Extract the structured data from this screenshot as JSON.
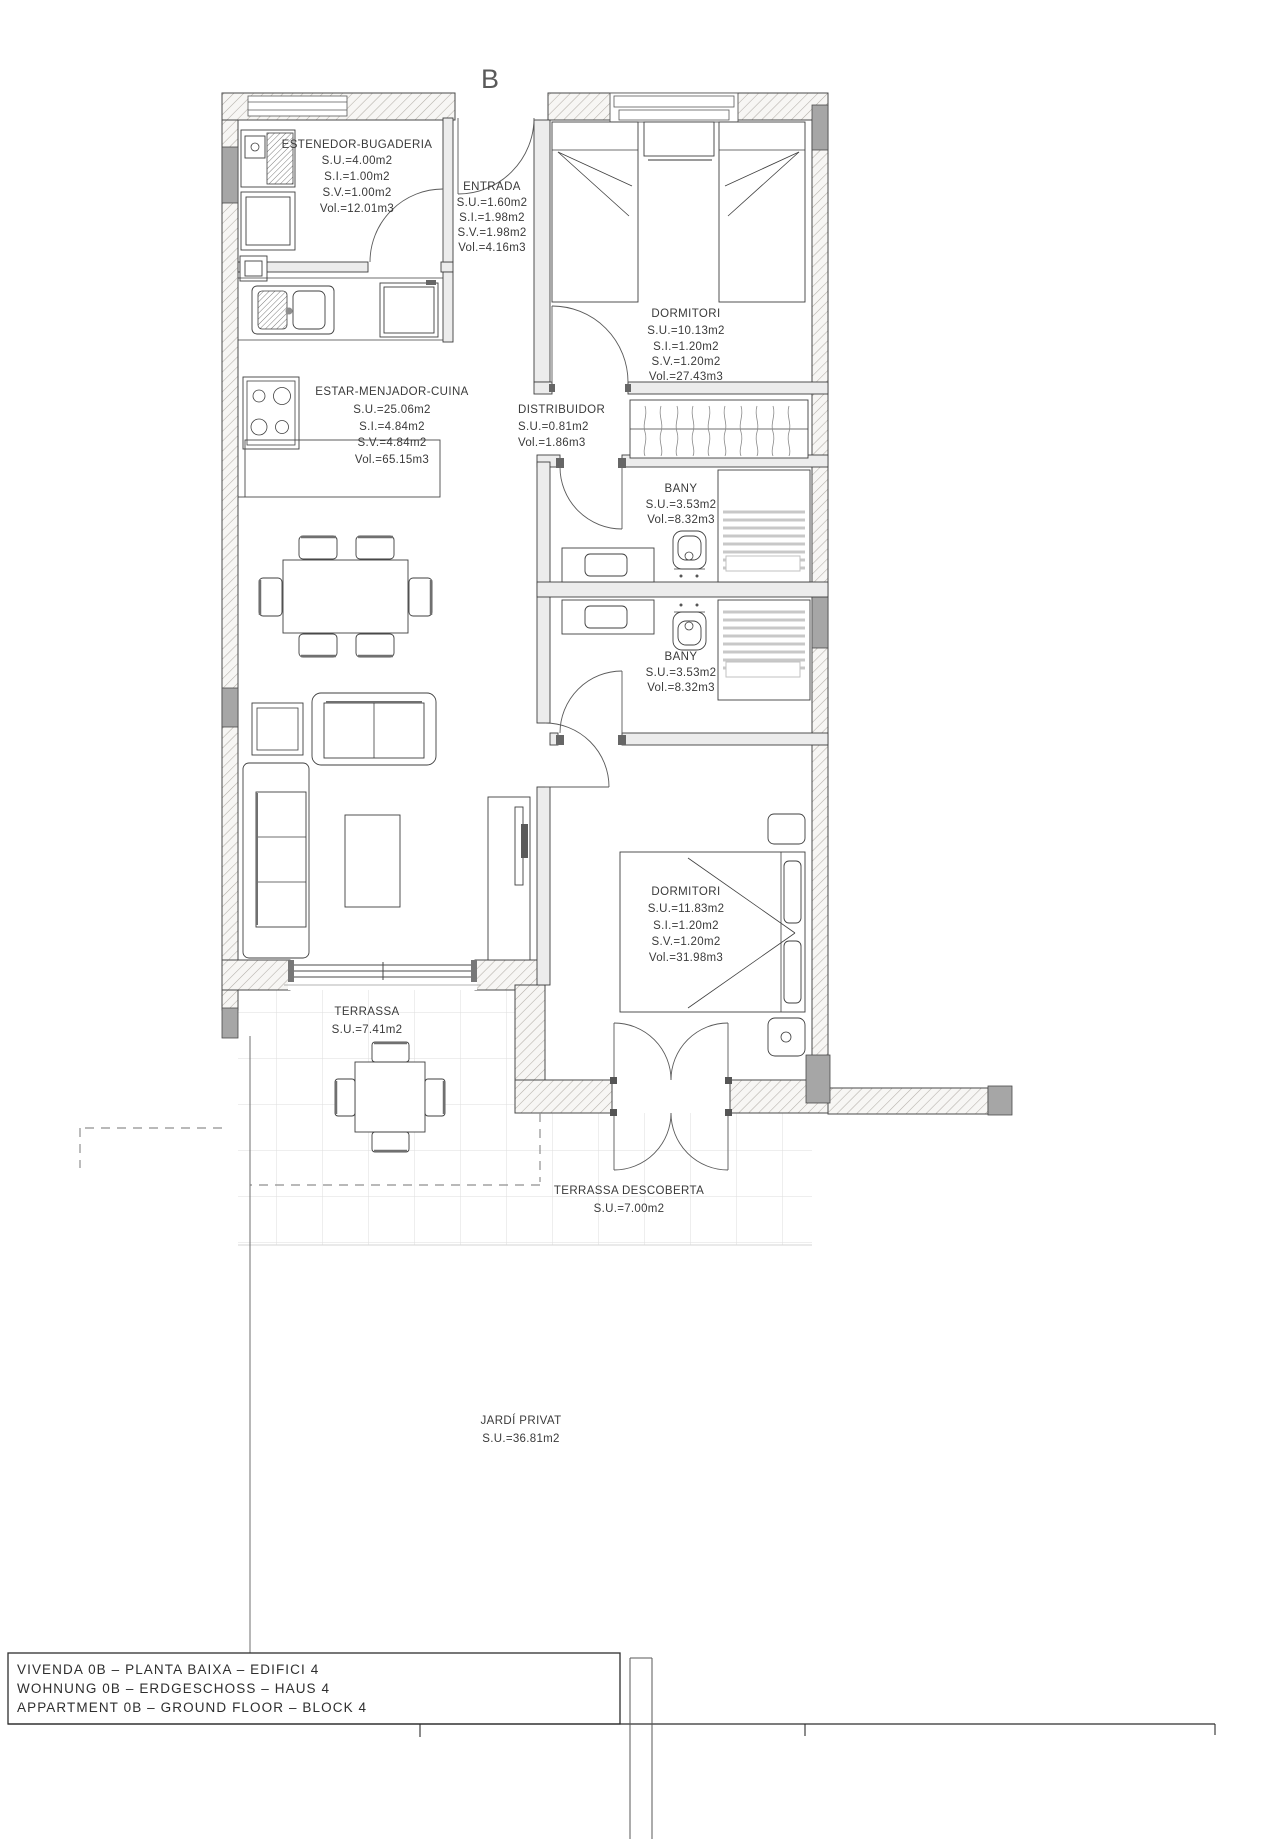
{
  "plan": {
    "label": "B"
  },
  "rooms": {
    "estenedor_bugaderia": {
      "name": "ESTENEDOR-BUGADERIA",
      "lines": [
        "S.U.=4.00m2",
        "S.I.=1.00m2",
        "S.V.=1.00m2",
        "Vol.=12.01m3"
      ]
    },
    "entrada": {
      "name": "ENTRADA",
      "lines": [
        "S.U.=1.60m2",
        "S.I.=1.98m2",
        "S.V.=1.98m2",
        "Vol.=4.16m3"
      ]
    },
    "dormitori_1": {
      "name": "DORMITORI",
      "lines": [
        "S.U.=10.13m2",
        "S.I.=1.20m2",
        "S.V.=1.20m2",
        "Vol.=27.43m3"
      ]
    },
    "estar_menjador_cuina": {
      "name": "ESTAR-MENJADOR-CUINA",
      "lines": [
        "S.U.=25.06m2",
        "S.I.=4.84m2",
        "S.V.=4.84m2",
        "Vol.=65.15m3"
      ]
    },
    "distribuidor": {
      "name": "DISTRIBUIDOR",
      "lines": [
        "S.U.=0.81m2",
        "Vol.=1.86m3"
      ]
    },
    "bany_1": {
      "name": "BANY",
      "lines": [
        "S.U.=3.53m2",
        "Vol.=8.32m3"
      ]
    },
    "bany_2": {
      "name": "BANY",
      "lines": [
        "S.U.=3.53m2",
        "Vol.=8.32m3"
      ]
    },
    "dormitori_2": {
      "name": "DORMITORI",
      "lines": [
        "S.U.=11.83m2",
        "S.I.=1.20m2",
        "S.V.=1.20m2",
        "Vol.=31.98m3"
      ]
    },
    "terrassa": {
      "name": "TERRASSA",
      "lines": [
        "S.U.=7.41m2"
      ]
    },
    "terrassa_descoberta": {
      "name": "TERRASSA DESCOBERTA",
      "lines": [
        "S.U.=7.00m2"
      ]
    },
    "jardi_privat": {
      "name": "JARDÍ PRIVAT",
      "lines": [
        "S.U.=36.81m2"
      ]
    }
  },
  "title_block": {
    "lines": [
      "VIVENDA 0B  –  PLANTA BAIXA  –  EDIFICI 4",
      "WOHNUNG 0B  –  ERDGESCHOSS  –  HAUS 4",
      "APPARTMENT 0B  –  GROUND FLOOR  –  BLOCK 4"
    ]
  },
  "palette": {
    "line": "#3f3f3f",
    "wall_hatch": "#b3aea8",
    "pier_fill": "#a6a6a6",
    "tile_line": "#dedede"
  }
}
